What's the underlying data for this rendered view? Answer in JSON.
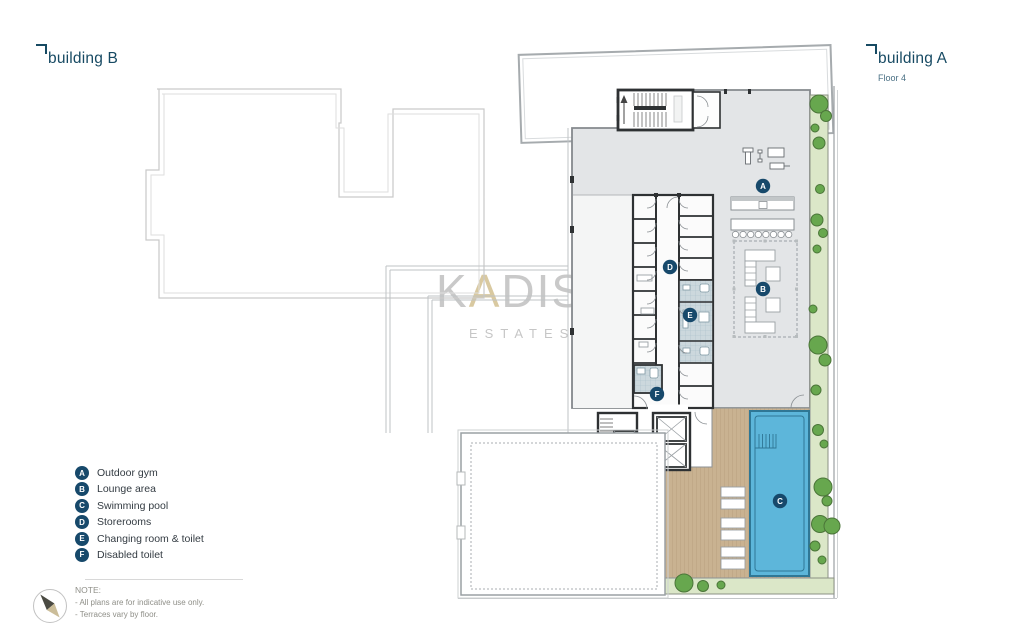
{
  "header": {
    "building_b": {
      "label": "building B"
    },
    "building_a": {
      "label": "building A",
      "floor": "Floor 4"
    }
  },
  "watermark": {
    "k": "K",
    "a": "A",
    "dis": "DIS",
    "sub": "ESTATES"
  },
  "legend": {
    "items": [
      {
        "letter": "A",
        "label": "Outdoor gym"
      },
      {
        "letter": "B",
        "label": "Lounge area"
      },
      {
        "letter": "C",
        "label": "Swimming pool"
      },
      {
        "letter": "D",
        "label": "Storerooms"
      },
      {
        "letter": "E",
        "label": "Changing room & toilet"
      },
      {
        "letter": "F",
        "label": "Disabled toilet"
      }
    ]
  },
  "note": {
    "title": "NOTE:",
    "lines": [
      "- All plans are for indicative use only.",
      "- Terraces vary by floor."
    ]
  },
  "icons": {
    "compass": "compass-needle-icon",
    "corner_bracket": "corner-bracket-icon"
  },
  "colors": {
    "accent_navy": "#17496b",
    "label_teal": "#174a63",
    "floor_plate": "#e3e5e7",
    "wall": "#2e3133",
    "pool_blue": "#5db6da",
    "pool_edge": "#2f7795",
    "deck_tan": "#c9b291",
    "garden_green": "#dbe7c8",
    "tree_green": "#67a74e",
    "watermark_gray": "#c9c9c9",
    "watermark_gold": "#d9c9a0"
  }
}
